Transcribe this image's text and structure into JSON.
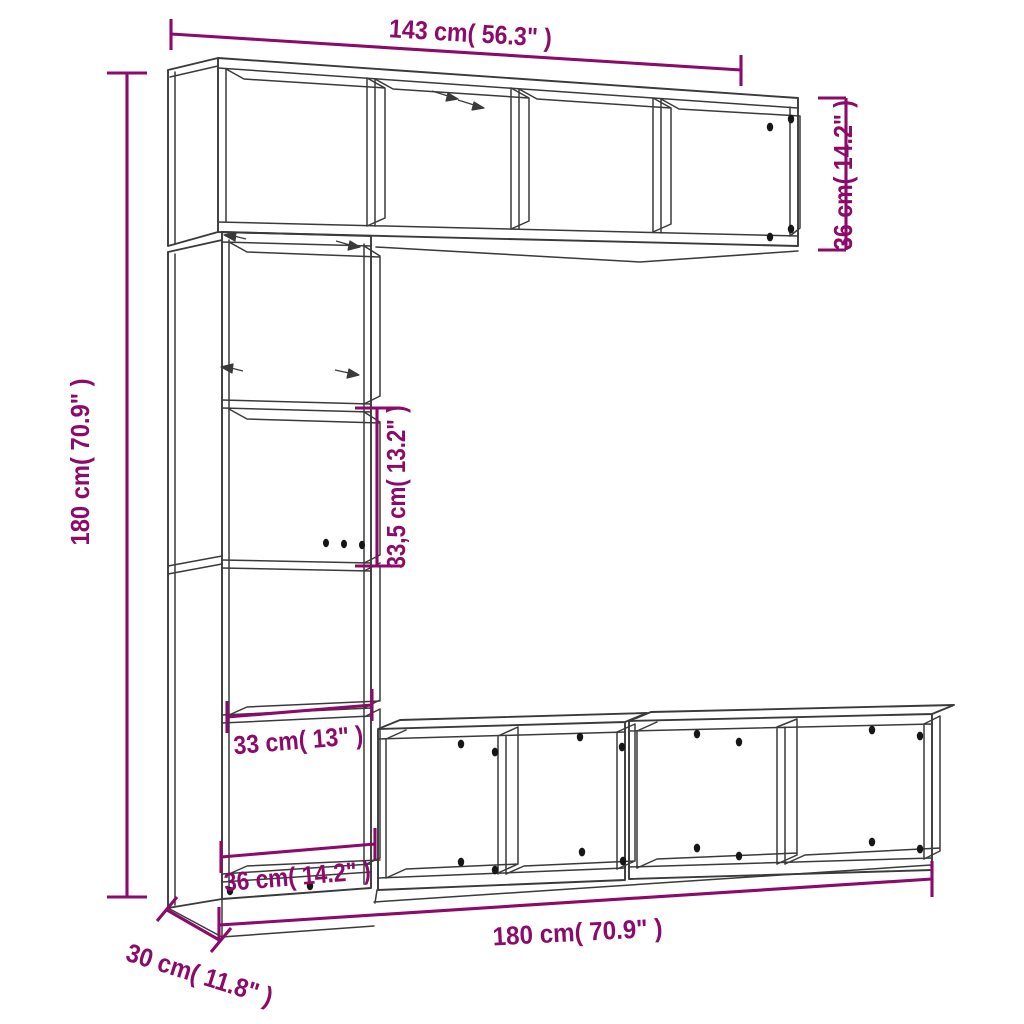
{
  "diagram": {
    "description": "3-piece book cabinet / TV wall unit set line drawing with measurements",
    "colors": {
      "background": "#ffffff",
      "line": "#3a3a3a",
      "dimension": "#8c0a69",
      "dot": "#161616"
    },
    "labels": {
      "top_width": "143 cm( 56.3\" )",
      "upper_unit_height": "36 cm( 14.2\" )",
      "total_height": "180 cm( 70.9\" )",
      "compartment_height": "33,5 cm( 13.2\" )",
      "compartment_width": "33 cm( 13\" )",
      "lower_compartment_width": "36 cm( 14.2\" )",
      "total_width": "180 cm( 70.9\" )",
      "depth": "30 cm( 11.8\" )"
    }
  }
}
